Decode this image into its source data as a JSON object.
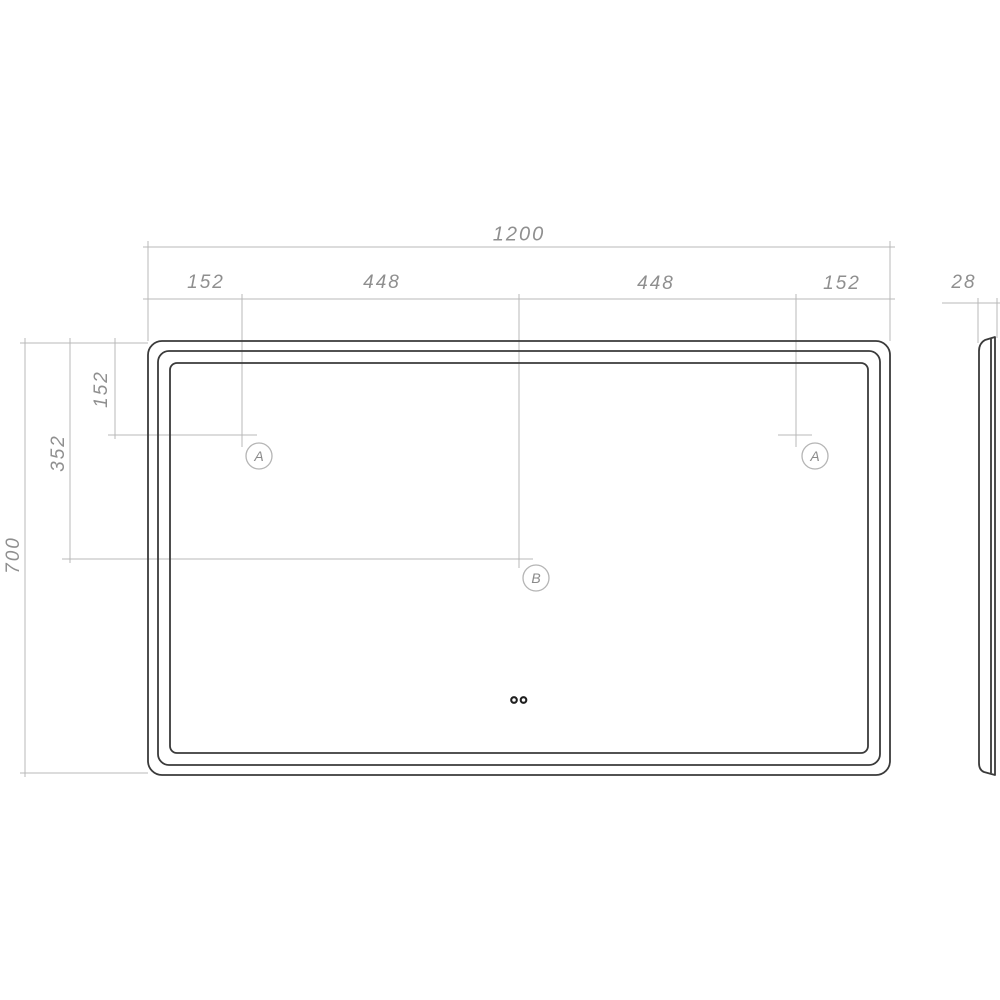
{
  "drawing": {
    "dimensions": {
      "width_total": "1200",
      "width_seg_left": "152",
      "width_seg_mid_left": "448",
      "width_seg_mid_right": "448",
      "width_seg_right": "152",
      "depth": "28",
      "height_total": "700",
      "height_to_center": "352",
      "height_to_sensor": "152"
    },
    "markers": {
      "a_left": "A",
      "a_right": "A",
      "b_center": "B"
    }
  },
  "colors": {
    "outline": "#3a3a3a",
    "dimension_line": "#b9b9b9",
    "text": "#8f8f8f",
    "marker_circle": "#b5b5b5",
    "marker_text": "#8a8a8a",
    "dot": "#1f1f1f",
    "background": "#ffffff"
  }
}
